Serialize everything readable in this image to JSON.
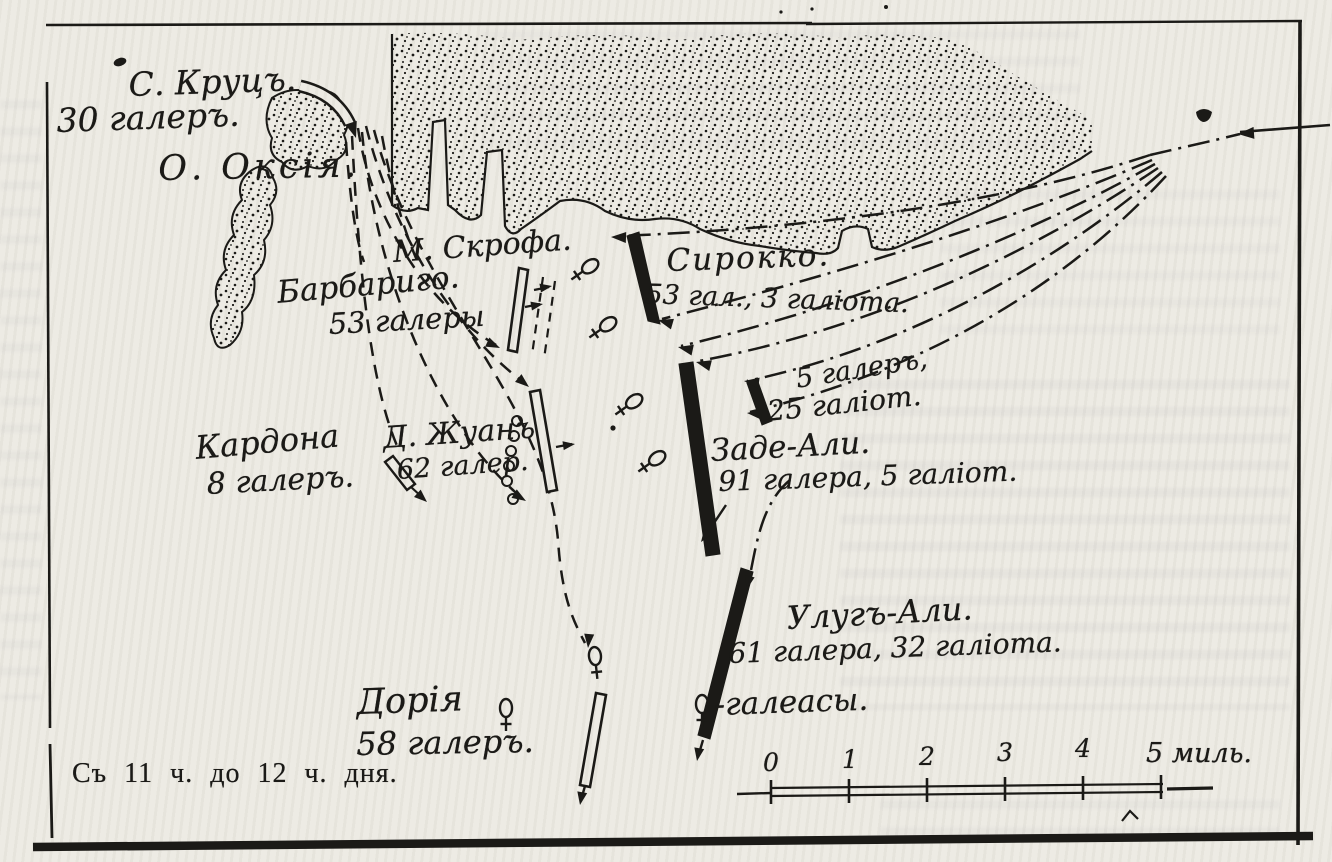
{
  "map": {
    "caption": "Съ 11 ч. до 12 ч. дня.",
    "island_label": "О. Оксія.",
    "cape_label": "М. Скрофа.",
    "squadrons": {
      "santa_cruz": {
        "name": "С. Круцъ.",
        "strength": "30 галеръ."
      },
      "barbarigo": {
        "name": "Барбариго.",
        "strength": "53 галеры"
      },
      "sirocco": {
        "name": "Сирокко.",
        "strength": "53 гал., 3 галіота."
      },
      "don_juan": {
        "name": "Д. Жуанъ",
        "strength": "62 галер."
      },
      "cardona": {
        "name": "Кардона",
        "strength": "8 галеръ."
      },
      "galliots": {
        "name": "5 галеръ,",
        "strength": "25 галіот."
      },
      "zade_ali": {
        "name": "Заде-Али.",
        "strength": "91 галера, 5 галіот."
      },
      "uluch_ali": {
        "name": "Улугъ-Али.",
        "strength": "61 галера, 32 галіота."
      },
      "doria": {
        "name": "Дорія",
        "strength": "58 галеръ."
      }
    },
    "legend": {
      "galleass_label": "-галеасы."
    },
    "scale": {
      "ticks": [
        "0",
        "1",
        "2",
        "3",
        "4"
      ],
      "end_label": "5 миль."
    },
    "colors": {
      "ink": "#1b1a17",
      "paper": "#edebe4"
    }
  }
}
